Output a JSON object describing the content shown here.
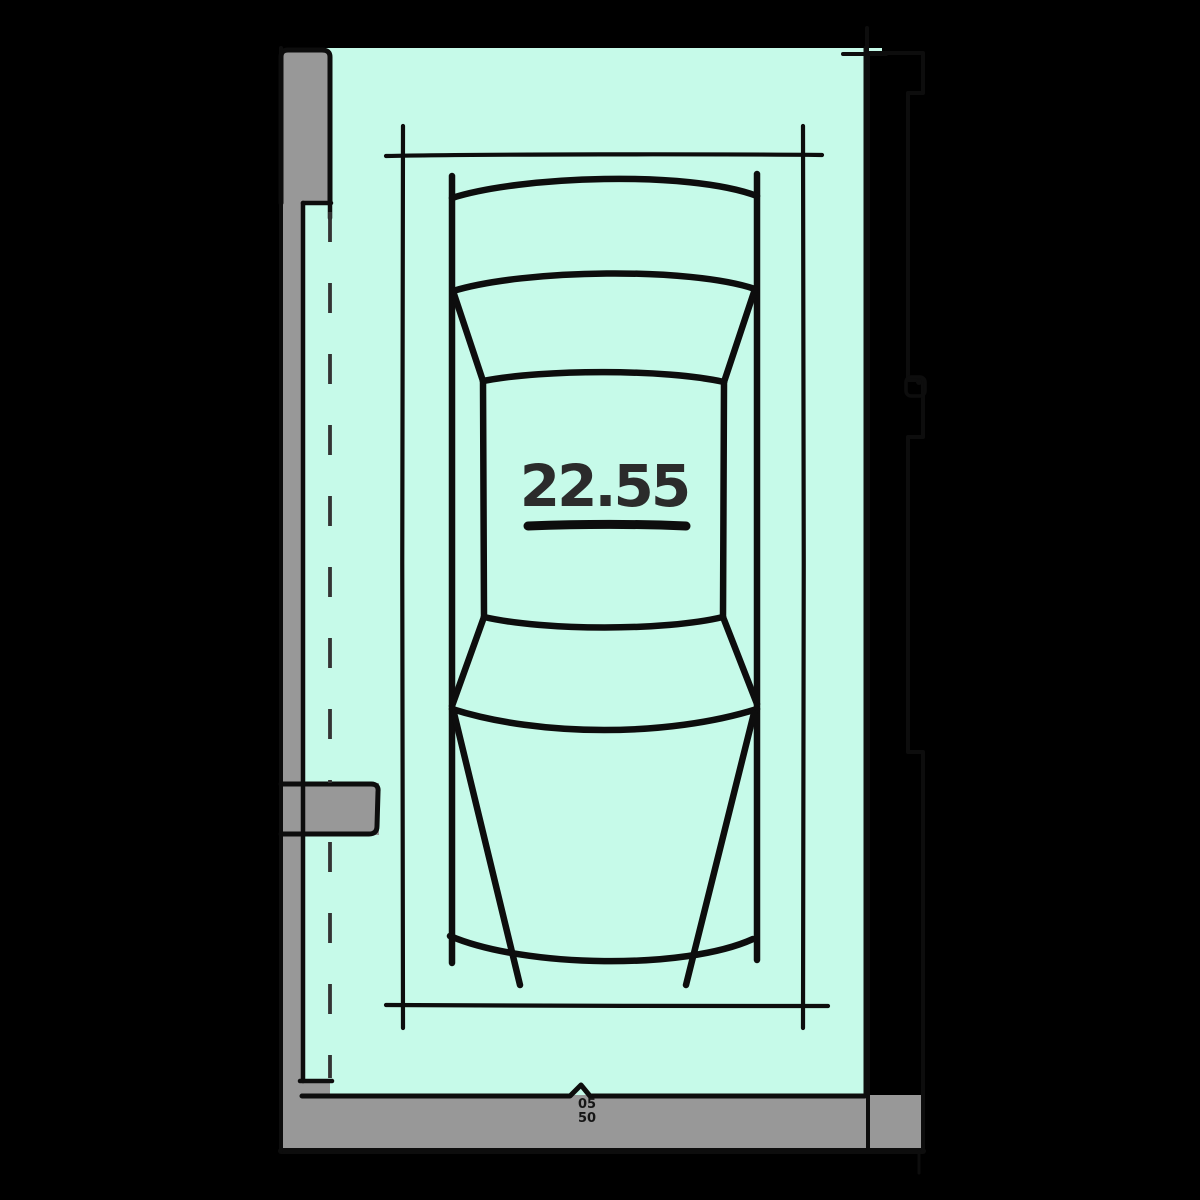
{
  "plan": {
    "area_value": "22.55",
    "note_line1": "05",
    "note_line2": "50"
  },
  "colors": {
    "background": "#000000",
    "space_fill": "#c6fae9",
    "wall_fill": "#989898",
    "fixture_fill": "#cfcfcf",
    "ink": "#0d0d0d",
    "dash": "#333333",
    "area_text": "#2b2b2b"
  }
}
